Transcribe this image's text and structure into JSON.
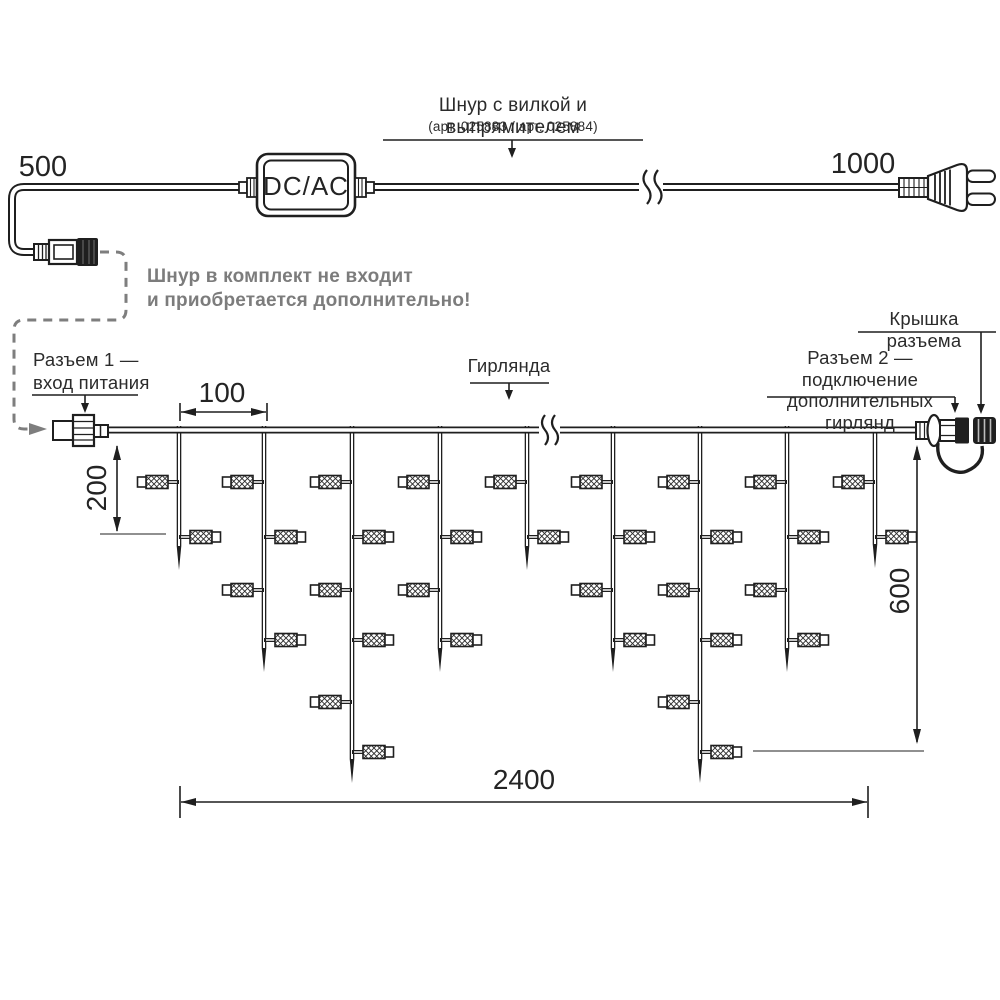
{
  "colors": {
    "ink": "#1f1f1f",
    "gray_note": "#7c7c7c",
    "gray_dashed": "#7e7e7e",
    "dim_ext": "#909090",
    "background": "#ffffff"
  },
  "cord": {
    "dim_left": "500",
    "dim_right": "1000",
    "converter": "DC/AC",
    "label_title": "Шнур с вилкой и выпрямителем",
    "label_articles": "(арт. 025883 / арт. 025884)",
    "note_line1": "Шнур в комплект не входит",
    "note_line2": "и приобретается дополнительно!"
  },
  "garland": {
    "label": "Гирлянда",
    "connector1_line1": "Разъем 1 —",
    "connector1_line2": "вход питания",
    "connector2_line1": "Разъем 2 — подключение",
    "connector2_line2": "дополнительных гирлянд",
    "cap_label": "Крышка разъема",
    "dim_spacing": "100",
    "dim_drop_length": "200",
    "dim_height": "600",
    "dim_total_width": "2400"
  },
  "diagram": {
    "wire": {
      "x1": 108,
      "x2": 916,
      "y": 430
    },
    "bulb_row_y": [
      482,
      537,
      590,
      640,
      702,
      752
    ],
    "drops": [
      {
        "x": 179,
        "bulbs": 2,
        "tip_y": 570
      },
      {
        "x": 264,
        "bulbs": 4,
        "tip_y": 672
      },
      {
        "x": 352,
        "bulbs": 6,
        "tip_y": 783
      },
      {
        "x": 440,
        "bulbs": 4,
        "tip_y": 672
      },
      {
        "x": 527,
        "bulbs": 2,
        "tip_y": 570
      },
      {
        "x": 613,
        "bulbs": 4,
        "tip_y": 672
      },
      {
        "x": 700,
        "bulbs": 6,
        "tip_y": 783
      },
      {
        "x": 787,
        "bulbs": 4,
        "tip_y": 672
      },
      {
        "x": 875,
        "bulbs": 2,
        "tip_y": 568
      }
    ]
  }
}
